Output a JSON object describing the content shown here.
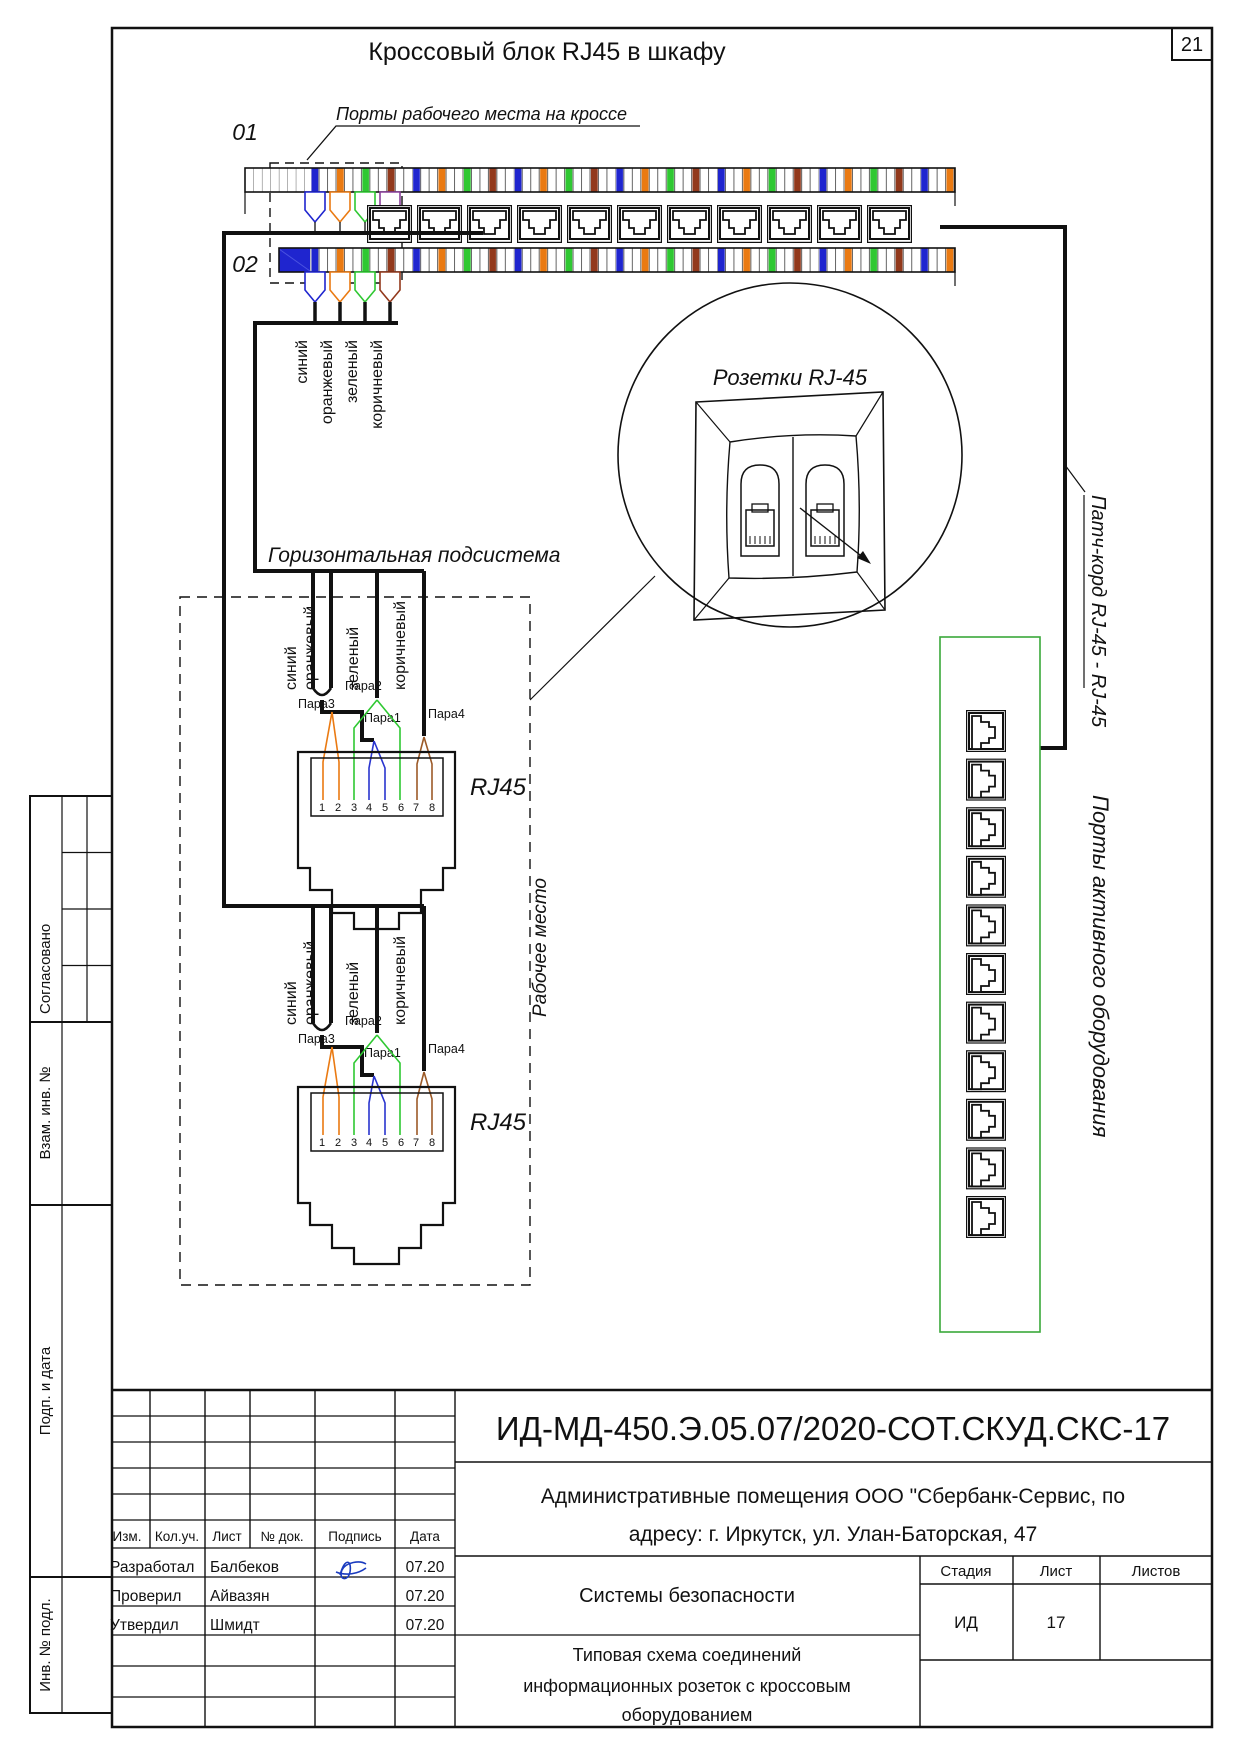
{
  "page": {
    "number": "21",
    "title": "Кроссовый блок RJ45 в шкафу"
  },
  "diagram": {
    "ports_label": "Порты рабочего места на кроссе",
    "block01": "01",
    "block02": "02",
    "horizontal_subsystem": "Горизонтальная подсистема",
    "sockets_label": "Розетки RJ-45",
    "workplace_label": "Рабочее место",
    "patch_cord_label": "Патч-корд RJ-45 - RJ-45",
    "active_ports_label": "Порты активного оборудования",
    "rj45_label": "RJ45",
    "wire_colors": [
      "синий",
      "оранжевый",
      "зеленый",
      "коричневый"
    ],
    "pairs": [
      "Пара1",
      "Пара2",
      "Пара3",
      "Пара4"
    ],
    "pins": [
      "1",
      "2",
      "3",
      "4",
      "5",
      "6",
      "7",
      "8"
    ],
    "accent_colors": {
      "blue": "#1f25cf",
      "orange": "#ea7a12",
      "green": "#2fc832",
      "brown": "#92391c",
      "violet": "#8a3f9b",
      "panel_green": "#3aa83a",
      "signature_blue": "#1a3bbf"
    }
  },
  "stamp": {
    "doc_number": "ИД-МД-450.Э.05.07/2020-СОТ.СКУД.СКС-17",
    "address_line1": "Административные помещения ООО \"Сбербанк-Сервис, по",
    "address_line2": "адресу: г. Иркутск, ул. Улан-Баторская, 47",
    "system": "Системы безопасности",
    "scheme_line1": "Типовая схема соединений",
    "scheme_line2": "информационных розеток с кроссовым",
    "scheme_line3": "оборудованием",
    "headers": [
      "Изм.",
      "Кол.уч.",
      "Лист",
      "№ док.",
      "Подпись",
      "Дата"
    ],
    "rows": [
      {
        "role": "Разработал",
        "name": "Балбеков",
        "date": "07.20"
      },
      {
        "role": "Проверил",
        "name": "Айвазян",
        "date": "07.20"
      },
      {
        "role": "Утвердил",
        "name": "Шмидт",
        "date": "07.20"
      }
    ],
    "stage_headers": [
      "Стадия",
      "Лист",
      "Листов"
    ],
    "stage": "ИД",
    "sheet": "17",
    "sheets_total": ""
  },
  "sidebar": {
    "items": [
      "Согласовано",
      "Взам. инв. №",
      "Подп. и дата",
      "Инв. № подл."
    ]
  }
}
